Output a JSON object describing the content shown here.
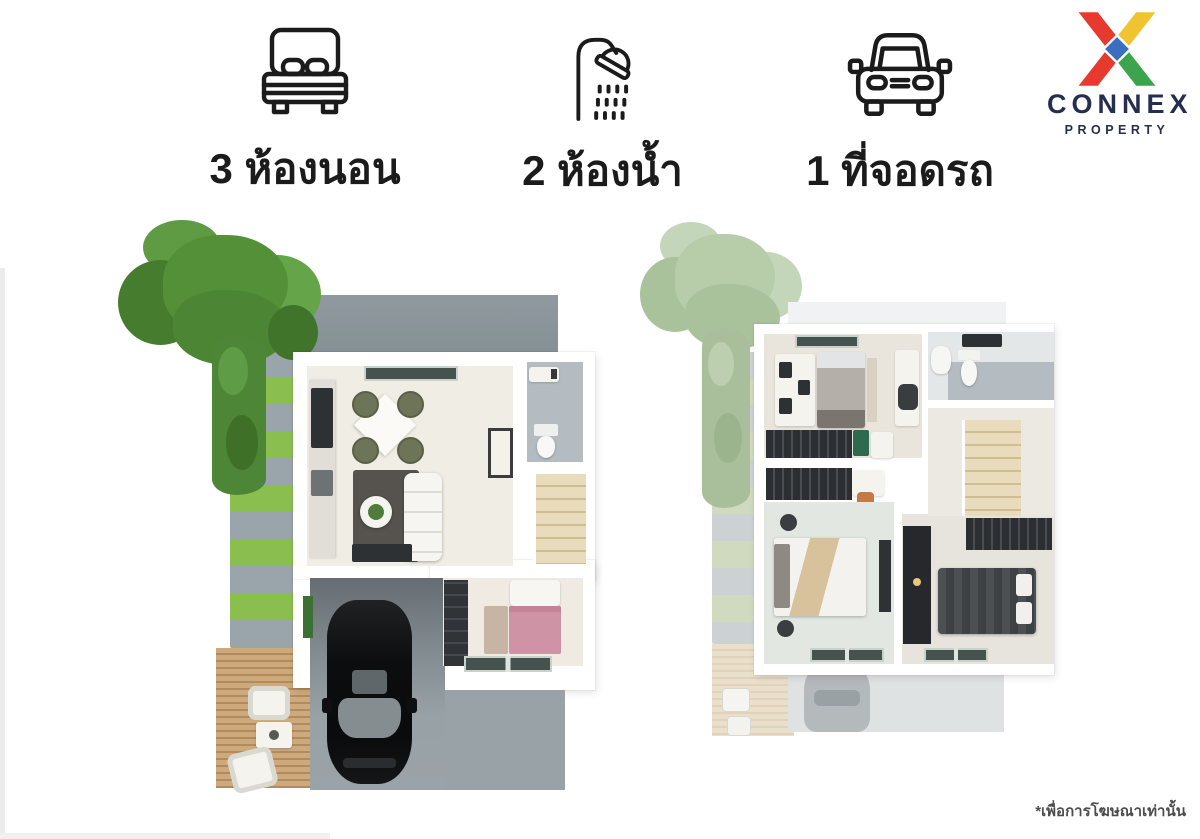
{
  "features": [
    {
      "icon": "bed-icon",
      "label": "3 ห้องนอน"
    },
    {
      "icon": "shower-icon",
      "label": "2 ห้องน้ำ"
    },
    {
      "icon": "car-icon",
      "label": "1 ที่จอดรถ"
    }
  ],
  "logo": {
    "title": "CONNEX",
    "subtitle": "PROPERTY"
  },
  "disclaimer": "*เพื่อการโฆษณาเท่านั้น",
  "plans": [
    {
      "name": "ground-floor-3d-plan"
    },
    {
      "name": "second-floor-3d-plan"
    }
  ],
  "palette": {
    "ink": "#1b1b1b",
    "logo-red": "#e63a2e",
    "logo-yellow": "#f0c330",
    "logo-green": "#3ea34d",
    "logo-blue": "#3a6fc0",
    "logo-navy": "#252e4e",
    "tree-1": "#539038",
    "tree-2": "#467c2d",
    "tree-3": "#66a44a",
    "tree-4": "#4c8634",
    "vine": "#4e8637",
    "grass": "#8abf4f",
    "paver": "#9aa4ab",
    "slab": "#8b959c",
    "garage": "#70787d",
    "drive": "#99a2a6",
    "wall": "#ffffff",
    "floor-cream": "#f0ede4",
    "floor-warm": "#eae5dc",
    "floor-mint": "#e2e7e1",
    "tile": "#b4bcc2",
    "stair": "#e8dcbc",
    "stair-line": "#cfbd94",
    "glass": "#46524d",
    "dark-furn": "#2e3134",
    "olive": "#6d7458",
    "rug-dark": "#56524e",
    "pink": "#cf93a6",
    "tan": "#d8c29b",
    "car-black": "#0c0d0e",
    "car-glass": "#868d91",
    "faded-tree-1": "#b7cdaa",
    "faded-tree-2": "#c4d6b9",
    "faded-tree-3": "#a9c29b",
    "faded-vine": "#a9bf9b",
    "faded-grass": "#cfdabf",
    "faded-paver": "#ccd2d4",
    "ghost": "#dfe2e3",
    "ghost-car": "#b4b9bc",
    "ghost-deck-a": "#eadfcb",
    "ghost-deck-b": "#e0d3ba",
    "disclaimer-color": "#4c4c4c"
  }
}
